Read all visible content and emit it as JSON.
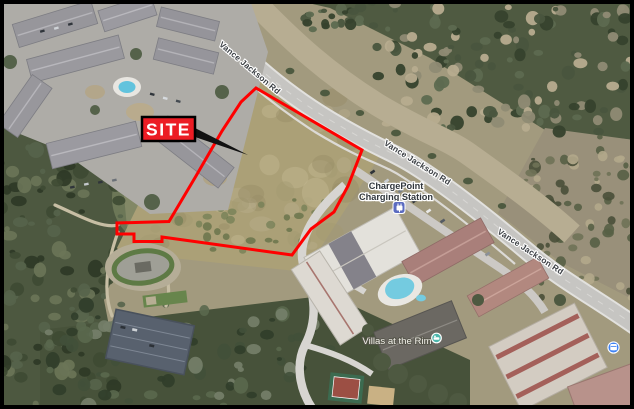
{
  "site_callout": {
    "label": "SITE"
  },
  "road_labels": [
    {
      "text": "Vance Jackson Rd"
    },
    {
      "text": "Vance Jackson Rd"
    },
    {
      "text": "Vance Jackson Rd"
    }
  ],
  "pois": {
    "charging_station": {
      "name_line1": "ChargePoint",
      "name_line2": "Charging Station",
      "icon": "ev-charging-icon",
      "icon_color": "#5b6bc0"
    },
    "villas": {
      "name": "Villas at the Rim",
      "icon": "lodging-marker-icon",
      "icon_color": "#4db6ac"
    },
    "transit_stop": {
      "icon": "transit-stop-icon",
      "icon_color": "#4285f4"
    }
  },
  "colors": {
    "site_outline": "#ff0000",
    "callout_bg": "#ec1c24",
    "callout_border": "#000000",
    "callout_text": "#ffffff"
  }
}
